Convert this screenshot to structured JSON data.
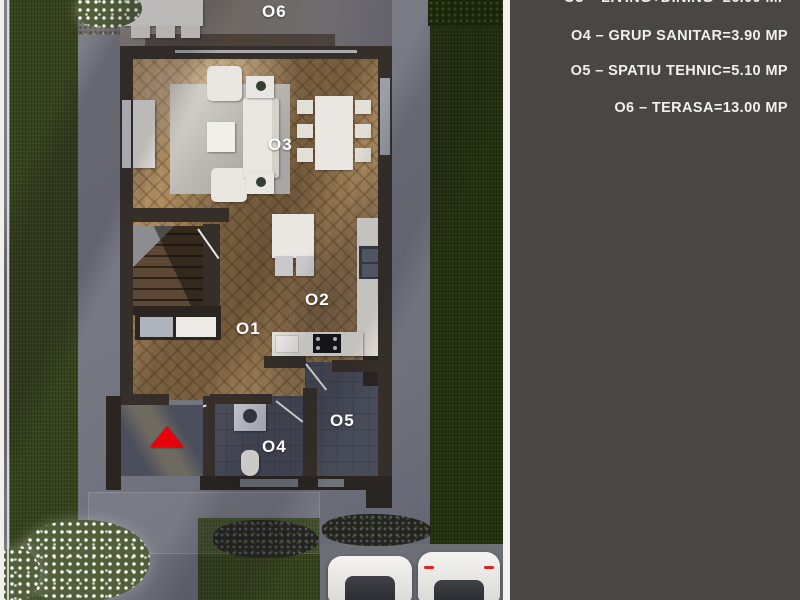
{
  "legend": {
    "panel_bg": "#484746",
    "text_color": "#f1f0ef",
    "lines": [
      {
        "text": "O3 – LIVING+DINING=26.00 MP"
      },
      {
        "text": "O4 – GRUP SANITAR=3.90 MP"
      },
      {
        "text": "O5 – SPATIU TEHNIC=5.10 MP"
      },
      {
        "text": "O6 – TERASA=13.00 MP"
      }
    ]
  },
  "floor_plan": {
    "room_labels": {
      "o1": "O1",
      "o2": "O2",
      "o3": "O3",
      "o4": "O4",
      "o5": "O5",
      "o6": "O6"
    },
    "entrance_marker_color": "#e8000a"
  }
}
